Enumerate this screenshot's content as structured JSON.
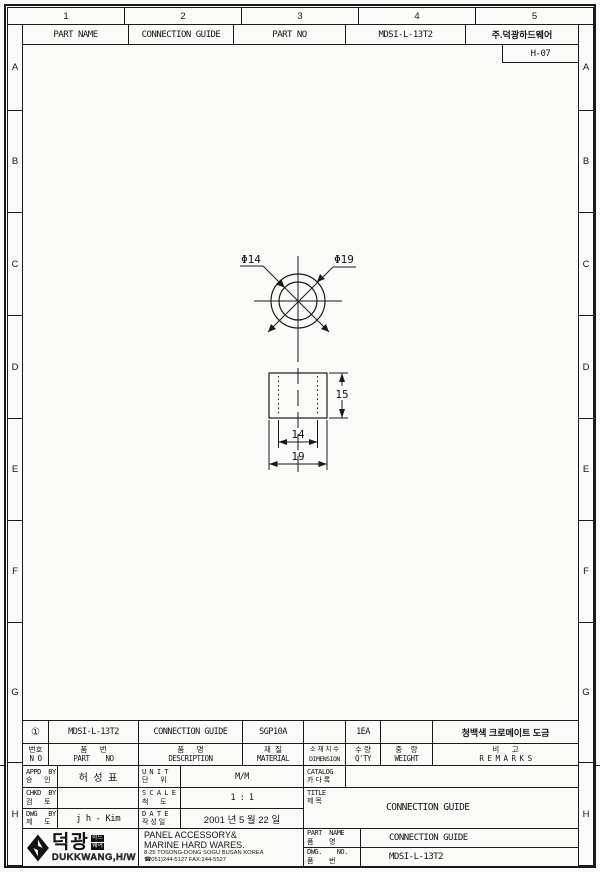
{
  "ruler": {
    "columns": [
      "1",
      "2",
      "3",
      "4",
      "5"
    ]
  },
  "row_letters": [
    "A",
    "B",
    "C",
    "D",
    "E",
    "F",
    "G",
    "H"
  ],
  "top_header": {
    "part_name_label": "PART NAME",
    "part_name_value": "CONNECTION GUIDE",
    "part_no_label": "PART NO",
    "part_no_value": "MDSI-L-13T2",
    "company_name": "주.덕광하드웨어",
    "sheet_code": "H-07"
  },
  "drawing": {
    "dia_inner": "Φ14",
    "dia_outer": "Φ19",
    "dim_height": "15",
    "dim_inner_width": "14",
    "dim_outer_width": "19"
  },
  "parts_table": {
    "headers": [
      {
        "ko": "번호",
        "en": "N O"
      },
      {
        "ko": "품      번",
        "en": "PART    NO"
      },
      {
        "ko": "품      명",
        "en": "DESCRIPTION"
      },
      {
        "ko": "재  질",
        "en": "MATERIAL"
      },
      {
        "ko": "소 재 치 수",
        "en": "DIMENSION"
      },
      {
        "ko": "수 량",
        "en": "Q'TY"
      },
      {
        "ko": "중    량",
        "en": "WEIGHT"
      },
      {
        "ko": "비      고",
        "en": "R E M A R K S"
      }
    ],
    "row": {
      "no": "①",
      "part_no": "MDSI-L-13T2",
      "description": "CONNECTION GUIDE",
      "material": "SGP10A",
      "dimension": "",
      "qty": "1EA",
      "weight": "",
      "remarks": "청백색 크로메이트 도금"
    }
  },
  "title_block": {
    "appd": {
      "en": "APPD  BY",
      "ko": "승      인",
      "value": "허  성  표"
    },
    "chkd": {
      "en": "CHKD  BY",
      "ko": "검      토",
      "value": ""
    },
    "dwgby": {
      "en": "DWG   BY",
      "ko": "제      도",
      "value": "j h - Kim"
    },
    "unit": {
      "en": "U N I T",
      "ko": "단      위",
      "value": "M/M"
    },
    "scale": {
      "en": "S C A L E",
      "ko": "척      도",
      "value": "1 : 1"
    },
    "date": {
      "en": "D A T E",
      "ko": "작 성 일",
      "value": "2001 년 5 월 22 일"
    },
    "catalog": {
      "en": "CATALOG",
      "ko": "카 다 록",
      "value": ""
    },
    "title": {
      "en": "TITLE",
      "ko": "제 목",
      "value": "CONNECTION GUIDE"
    },
    "part_name": {
      "en": "PART  NAME",
      "ko": "품        명",
      "value": "CONNECTION GUIDE"
    },
    "dwg_no": {
      "en": "DWG.    NO.",
      "ko": "품        번",
      "value": "MDSI-L-13T2"
    }
  },
  "company": {
    "logo_kr": "덕광",
    "logo_sub_top": "하드",
    "logo_sub_bottom": "웨어",
    "logo_en": "DUKKWANG,H/W",
    "line1": "PANEL ACCESSORY&",
    "line2": "MARINE HARD WARES.",
    "line3": "8-25 TOSONG-DONG SOGU BUSAN KOREA",
    "line4": "☎051)244-5127 FAX:244-5527"
  },
  "colors": {
    "line": "#1a1a1a",
    "paper": "#fbfbf9"
  }
}
